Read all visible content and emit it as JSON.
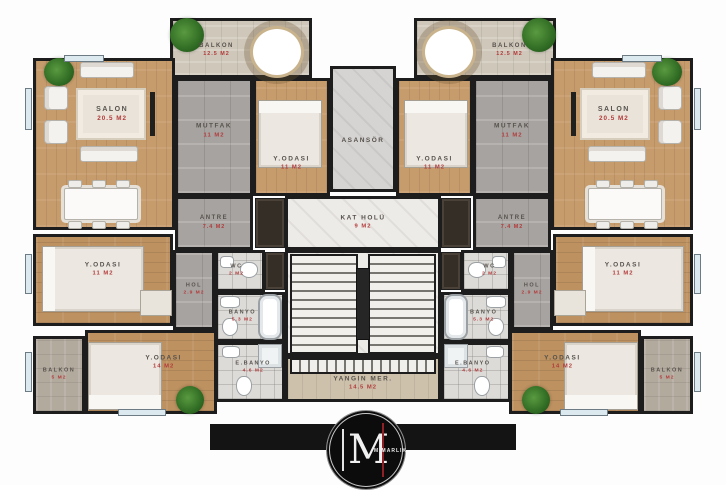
{
  "palette": {
    "wall": "#1d1d1d",
    "wood": "#c79c6d",
    "tile": "#a7a3a0",
    "bath_tile": "#dddbd8",
    "marble": "#edebe8",
    "balcony": "#cfc7ba",
    "room_label": "#57524d",
    "area_label": "#b23b3b",
    "logo_bg": "#0c0c0c",
    "logo_accent": "#8e2026"
  },
  "rooms": [
    {
      "id": "balkon-ust-sol",
      "label": "BALKON",
      "area": "12.5 M2",
      "x": 170,
      "y": 18,
      "w": 142,
      "h": 60,
      "floor": "balcony",
      "lx": 32,
      "ly": 55,
      "fs": 6
    },
    {
      "id": "salon-sol",
      "label": "SALON",
      "area": "20.5 M2",
      "x": 33,
      "y": 58,
      "w": 142,
      "h": 172,
      "floor": "wood",
      "lx": 56,
      "ly": 32,
      "fs": 7
    },
    {
      "id": "mutfak-sol",
      "label": "MUTFAK",
      "area": "11 M2",
      "x": 175,
      "y": 78,
      "w": 78,
      "h": 118,
      "floor": "tile",
      "ly": 45,
      "fs": 6.5
    },
    {
      "id": "yatak-odasi-sol-ust",
      "label": "Y.ODASI",
      "area": "11 M2",
      "x": 253,
      "y": 78,
      "w": 77,
      "h": 118,
      "floor": "wood",
      "ly": 74,
      "fs": 6.5
    },
    {
      "id": "antre-sol",
      "label": "ANTRE",
      "area": "7.4 M2",
      "x": 175,
      "y": 196,
      "w": 78,
      "h": 54,
      "floor": "tile",
      "fs": 6
    },
    {
      "id": "yatak-odasi-sol-orta",
      "label": "Y.ODASI",
      "area": "11 M2",
      "x": 33,
      "y": 234,
      "w": 140,
      "h": 92,
      "floor": "woodh",
      "ly": 38,
      "fs": 6.5
    },
    {
      "id": "hol-sol",
      "label": "HOL",
      "area": "2.9 M2",
      "x": 173,
      "y": 250,
      "w": 42,
      "h": 80,
      "floor": "tile",
      "fs": 5.5
    },
    {
      "id": "wc-sol",
      "label": "WC",
      "area": "2 M2",
      "x": 215,
      "y": 250,
      "w": 50,
      "h": 42,
      "floor": "bath",
      "lx": 42,
      "fs": 5.5
    },
    {
      "id": "banyo-sol",
      "label": "BANYO",
      "area": "5.3 M2",
      "x": 215,
      "y": 292,
      "w": 70,
      "h": 50,
      "floor": "bath",
      "lx": 38,
      "fs": 5.5
    },
    {
      "id": "ebanyo-sol",
      "label": "E.BANYO",
      "area": "4.6 M2",
      "x": 215,
      "y": 342,
      "w": 70,
      "h": 60,
      "floor": "bath",
      "lx": 55,
      "ly": 42,
      "fs": 5.5
    },
    {
      "id": "yatak-odasi-sol-alt",
      "label": "Y.ODASI",
      "area": "14 M2",
      "x": 85,
      "y": 330,
      "w": 132,
      "h": 84,
      "floor": "woodh",
      "lx": 60,
      "ly": 38,
      "fs": 6.5
    },
    {
      "id": "balkon-alt-sol",
      "label": "BALKON",
      "area": "5 M2",
      "x": 33,
      "y": 336,
      "w": 52,
      "h": 78,
      "floor": "stone",
      "fs": 5.5
    },
    {
      "id": "asansor",
      "label": "ASANSÖR",
      "area": "",
      "x": 330,
      "y": 66,
      "w": 66,
      "h": 126,
      "floor": "shaft",
      "ly": 60,
      "fs": 6.5
    },
    {
      "id": "kat-holu",
      "label": "KAT HOLÜ",
      "area": "9 M2",
      "x": 285,
      "y": 196,
      "w": 156,
      "h": 54,
      "floor": "marble",
      "fs": 6.5
    },
    {
      "id": "merdiven",
      "label": "",
      "area": "",
      "x": 285,
      "y": 250,
      "w": 156,
      "h": 106,
      "floor": "marble",
      "fs": 6
    },
    {
      "id": "yangin-merdiveni",
      "label": "YANGIN MER.",
      "area": "14.5 M2",
      "x": 285,
      "y": 356,
      "w": 156,
      "h": 46,
      "floor": "fire",
      "ly": 62,
      "fs": 6.5
    },
    {
      "id": "balkon-ust-sag",
      "label": "BALKON",
      "area": "12.5 M2",
      "x": 414,
      "y": 18,
      "w": 142,
      "h": 60,
      "floor": "balcony",
      "lx": 68,
      "ly": 55,
      "fs": 6
    },
    {
      "id": "yatak-odasi-sag-ust",
      "label": "Y.ODASI",
      "area": "11 M2",
      "x": 396,
      "y": 78,
      "w": 77,
      "h": 118,
      "floor": "wood",
      "ly": 74,
      "fs": 6.5
    },
    {
      "id": "mutfak-sag",
      "label": "MUTFAK",
      "area": "11 M2",
      "x": 473,
      "y": 78,
      "w": 78,
      "h": 118,
      "floor": "tile",
      "ly": 45,
      "fs": 6.5
    },
    {
      "id": "salon-sag",
      "label": "SALON",
      "area": "20.5 M2",
      "x": 551,
      "y": 58,
      "w": 142,
      "h": 172,
      "floor": "wood",
      "lx": 44,
      "ly": 32,
      "fs": 7
    },
    {
      "id": "antre-sag",
      "label": "ANTRE",
      "area": "7.4 M2",
      "x": 473,
      "y": 196,
      "w": 78,
      "h": 54,
      "floor": "tile",
      "fs": 6
    },
    {
      "id": "hol-sag",
      "label": "HOL",
      "area": "2.9 M2",
      "x": 511,
      "y": 250,
      "w": 42,
      "h": 80,
      "floor": "tile",
      "fs": 5.5
    },
    {
      "id": "wc-sag",
      "label": "WC",
      "area": "2 M2",
      "x": 461,
      "y": 250,
      "w": 50,
      "h": 42,
      "floor": "bath",
      "lx": 58,
      "fs": 5.5
    },
    {
      "id": "banyo-sag",
      "label": "BANYO",
      "area": "5.3 M2",
      "x": 441,
      "y": 292,
      "w": 70,
      "h": 50,
      "floor": "bath",
      "lx": 62,
      "fs": 5.5
    },
    {
      "id": "ebanyo-sag",
      "label": "E.BANYO",
      "area": "4.6 M2",
      "x": 441,
      "y": 342,
      "w": 70,
      "h": 60,
      "floor": "bath",
      "lx": 45,
      "ly": 42,
      "fs": 5.5
    },
    {
      "id": "yatak-odasi-sag-orta",
      "label": "Y.ODASI",
      "area": "11 M2",
      "x": 553,
      "y": 234,
      "w": 140,
      "h": 92,
      "floor": "woodh",
      "ly": 38,
      "fs": 6.5
    },
    {
      "id": "yatak-odasi-sag-alt",
      "label": "Y.ODASI",
      "area": "14 M2",
      "x": 509,
      "y": 330,
      "w": 132,
      "h": 84,
      "floor": "woodh",
      "lx": 40,
      "ly": 38,
      "fs": 6.5
    },
    {
      "id": "balkon-alt-sag",
      "label": "BALKON",
      "area": "5 M2",
      "x": 641,
      "y": 336,
      "w": 52,
      "h": 78,
      "floor": "stone",
      "fs": 5.5
    }
  ],
  "furniture": [
    {
      "t": "rug",
      "x": 76,
      "y": 88,
      "w": 70,
      "h": 52
    },
    {
      "t": "sofa",
      "x": 80,
      "y": 62,
      "w": 54,
      "h": 16
    },
    {
      "t": "sofa",
      "x": 80,
      "y": 146,
      "w": 58,
      "h": 16
    },
    {
      "t": "armchair",
      "x": 44,
      "y": 86,
      "w": 24,
      "h": 24
    },
    {
      "t": "armchair",
      "x": 44,
      "y": 120,
      "w": 24,
      "h": 24
    },
    {
      "t": "tv",
      "x": 150,
      "y": 92,
      "w": 5,
      "h": 44
    },
    {
      "t": "table",
      "x": 64,
      "y": 188,
      "w": 74,
      "h": 32
    },
    {
      "t": "chair-s",
      "x": 68,
      "y": 180,
      "w": 14,
      "h": 8
    },
    {
      "t": "chair-s",
      "x": 92,
      "y": 180,
      "w": 14,
      "h": 8
    },
    {
      "t": "chair-s",
      "x": 116,
      "y": 180,
      "w": 14,
      "h": 8
    },
    {
      "t": "chair-s",
      "x": 68,
      "y": 221,
      "w": 14,
      "h": 8
    },
    {
      "t": "chair-s",
      "x": 92,
      "y": 221,
      "w": 14,
      "h": 8
    },
    {
      "t": "chair-s",
      "x": 116,
      "y": 221,
      "w": 14,
      "h": 8
    },
    {
      "t": "round-table",
      "x": 250,
      "y": 26,
      "w": 54,
      "h": 52
    },
    {
      "t": "plant",
      "x": 44,
      "y": 58,
      "w": 30,
      "h": 28
    },
    {
      "t": "plant",
      "x": 170,
      "y": 18,
      "w": 34,
      "h": 34
    },
    {
      "t": "bed-v",
      "x": 258,
      "y": 100,
      "w": 64,
      "h": 68
    },
    {
      "t": "bed-h",
      "x": 42,
      "y": 246,
      "w": 102,
      "h": 66
    },
    {
      "t": "desk",
      "x": 140,
      "y": 290,
      "w": 32,
      "h": 26
    },
    {
      "t": "bed-b",
      "x": 88,
      "y": 342,
      "w": 74,
      "h": 68
    },
    {
      "t": "plant",
      "x": 176,
      "y": 386,
      "w": 28,
      "h": 28
    },
    {
      "t": "tub",
      "x": 258,
      "y": 294,
      "w": 24,
      "h": 46
    },
    {
      "t": "toilet",
      "x": 240,
      "y": 262,
      "w": 18,
      "h": 16
    },
    {
      "t": "sink",
      "x": 220,
      "y": 256,
      "w": 14,
      "h": 12
    },
    {
      "t": "sink",
      "x": 220,
      "y": 296,
      "w": 20,
      "h": 12
    },
    {
      "t": "toilet",
      "x": 222,
      "y": 318,
      "w": 16,
      "h": 18
    },
    {
      "t": "sink",
      "x": 222,
      "y": 346,
      "w": 18,
      "h": 12
    },
    {
      "t": "toilet",
      "x": 236,
      "y": 376,
      "w": 16,
      "h": 20
    },
    {
      "t": "shower",
      "x": 258,
      "y": 344,
      "w": 24,
      "h": 24
    },
    {
      "t": "rug",
      "x": 580,
      "y": 88,
      "w": 70,
      "h": 52
    },
    {
      "t": "sofa",
      "x": 592,
      "y": 62,
      "w": 54,
      "h": 16
    },
    {
      "t": "sofa",
      "x": 588,
      "y": 146,
      "w": 58,
      "h": 16
    },
    {
      "t": "armchair",
      "x": 658,
      "y": 86,
      "w": 24,
      "h": 24
    },
    {
      "t": "armchair",
      "x": 658,
      "y": 120,
      "w": 24,
      "h": 24
    },
    {
      "t": "tv",
      "x": 571,
      "y": 92,
      "w": 5,
      "h": 44
    },
    {
      "t": "table",
      "x": 588,
      "y": 188,
      "w": 74,
      "h": 32
    },
    {
      "t": "chair-s",
      "x": 596,
      "y": 180,
      "w": 14,
      "h": 8
    },
    {
      "t": "chair-s",
      "x": 620,
      "y": 180,
      "w": 14,
      "h": 8
    },
    {
      "t": "chair-s",
      "x": 644,
      "y": 180,
      "w": 14,
      "h": 8
    },
    {
      "t": "chair-s",
      "x": 596,
      "y": 221,
      "w": 14,
      "h": 8
    },
    {
      "t": "chair-s",
      "x": 620,
      "y": 221,
      "w": 14,
      "h": 8
    },
    {
      "t": "chair-s",
      "x": 644,
      "y": 221,
      "w": 14,
      "h": 8
    },
    {
      "t": "round-table",
      "x": 422,
      "y": 26,
      "w": 54,
      "h": 52
    },
    {
      "t": "plant",
      "x": 652,
      "y": 58,
      "w": 30,
      "h": 28
    },
    {
      "t": "plant",
      "x": 522,
      "y": 18,
      "w": 34,
      "h": 34
    },
    {
      "t": "bed-v",
      "x": 404,
      "y": 100,
      "w": 64,
      "h": 68
    },
    {
      "t": "bed-h",
      "x": 582,
      "y": 246,
      "w": 102,
      "h": 66
    },
    {
      "t": "desk",
      "x": 554,
      "y": 290,
      "w": 32,
      "h": 26
    },
    {
      "t": "bed-b",
      "x": 564,
      "y": 342,
      "w": 74,
      "h": 68
    },
    {
      "t": "plant",
      "x": 522,
      "y": 386,
      "w": 28,
      "h": 28
    },
    {
      "t": "tub",
      "x": 444,
      "y": 294,
      "w": 24,
      "h": 46
    },
    {
      "t": "toilet",
      "x": 468,
      "y": 262,
      "w": 18,
      "h": 16
    },
    {
      "t": "sink",
      "x": 492,
      "y": 256,
      "w": 14,
      "h": 12
    },
    {
      "t": "sink",
      "x": 486,
      "y": 296,
      "w": 20,
      "h": 12
    },
    {
      "t": "toilet",
      "x": 488,
      "y": 318,
      "w": 16,
      "h": 18
    },
    {
      "t": "sink",
      "x": 486,
      "y": 346,
      "w": 18,
      "h": 12
    },
    {
      "t": "toilet",
      "x": 474,
      "y": 376,
      "w": 16,
      "h": 20
    },
    {
      "t": "shower",
      "x": 444,
      "y": 344,
      "w": 24,
      "h": 24
    },
    {
      "t": "stairs-v",
      "x": 290,
      "y": 254,
      "w": 68,
      "h": 100
    },
    {
      "t": "stairs-v",
      "x": 368,
      "y": 254,
      "w": 68,
      "h": 100
    },
    {
      "t": "rail",
      "x": 356,
      "y": 268,
      "w": 14,
      "h": 72
    },
    {
      "t": "stairs-h",
      "x": 290,
      "y": 358,
      "w": 146,
      "h": 16
    },
    {
      "t": "closet",
      "x": 255,
      "y": 198,
      "w": 30,
      "h": 50
    },
    {
      "t": "closet",
      "x": 441,
      "y": 198,
      "w": 30,
      "h": 50
    },
    {
      "t": "closet",
      "x": 265,
      "y": 252,
      "w": 20,
      "h": 38
    },
    {
      "t": "closet",
      "x": 441,
      "y": 252,
      "w": 20,
      "h": 38
    },
    {
      "t": "window",
      "x": 25,
      "y": 88,
      "w": 7,
      "h": 42
    },
    {
      "t": "window",
      "x": 25,
      "y": 254,
      "w": 7,
      "h": 40
    },
    {
      "t": "window",
      "x": 25,
      "y": 352,
      "w": 7,
      "h": 40
    },
    {
      "t": "window",
      "x": 694,
      "y": 88,
      "w": 7,
      "h": 42
    },
    {
      "t": "window",
      "x": 694,
      "y": 254,
      "w": 7,
      "h": 40
    },
    {
      "t": "window",
      "x": 694,
      "y": 352,
      "w": 7,
      "h": 40
    },
    {
      "t": "window",
      "x": 64,
      "y": 55,
      "w": 40,
      "h": 7
    },
    {
      "t": "window",
      "x": 622,
      "y": 55,
      "w": 40,
      "h": 7
    },
    {
      "t": "window",
      "x": 118,
      "y": 409,
      "w": 48,
      "h": 7
    },
    {
      "t": "window",
      "x": 560,
      "y": 409,
      "w": 48,
      "h": 7
    }
  ],
  "logo": {
    "initial": "M",
    "text": "MİMARLIK"
  }
}
